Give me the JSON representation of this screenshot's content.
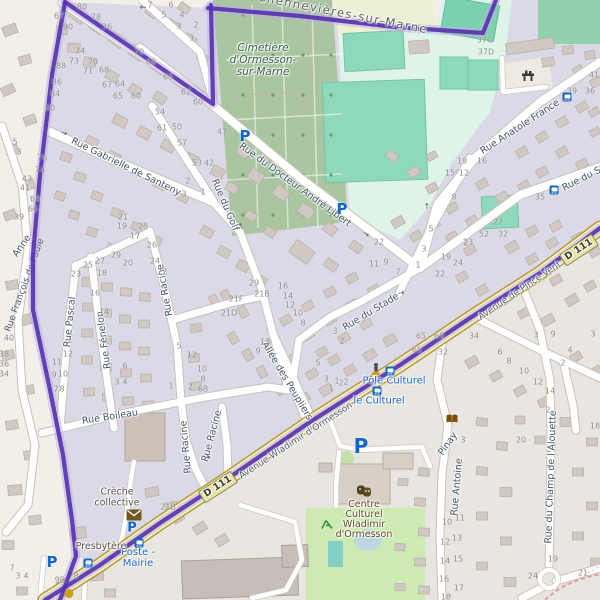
{
  "admin_label": "Chennevières-sur-Marne",
  "cemetery_label": {
    "lines": [
      "Cimetière",
      "d'Ormesson-",
      "sur-Marne"
    ]
  },
  "road_refs": [
    {
      "label": "D 111",
      "x": 218,
      "y": 487,
      "rot": -33
    },
    {
      "label": "D 111",
      "x": 579,
      "y": 250,
      "rot": -33
    }
  ],
  "streets": [
    {
      "label": "Rue Gabrielle de Santeny",
      "x": 126,
      "y": 167,
      "rot": 26
    },
    {
      "label": "Rue du Docteur André Libert",
      "x": 295,
      "y": 185,
      "rot": 36
    },
    {
      "label": "Rue du Golf",
      "x": 225,
      "y": 205,
      "rot": 67
    },
    {
      "label": "Rue Pascal",
      "x": 70,
      "y": 322,
      "rot": -84
    },
    {
      "label": "Rue Fénelon",
      "x": 104,
      "y": 340,
      "rot": -98
    },
    {
      "label": "Rue Racine",
      "x": 165,
      "y": 290,
      "rot": -100
    },
    {
      "label": "Rue Racine",
      "x": 186,
      "y": 447,
      "rot": -95
    },
    {
      "label": "Rue Racine",
      "x": 212,
      "y": 436,
      "rot": -75
    },
    {
      "label": "Rue Boileau",
      "x": 110,
      "y": 417,
      "rot": -9
    },
    {
      "label": "Allée des Peupliers",
      "x": 287,
      "y": 381,
      "rot": 59
    },
    {
      "label": "Rue du Stade",
      "x": 371,
      "y": 312,
      "rot": -31
    },
    {
      "label": "Rue du Sta",
      "x": 586,
      "y": 177,
      "rot": -27
    },
    {
      "label": "Rue Anatole France",
      "x": 520,
      "y": 127,
      "rot": -33
    },
    {
      "label": "Avenue Wladimir d'Ormesson",
      "x": 296,
      "y": 441,
      "rot": -33,
      "onroad": true
    },
    {
      "label": "Avenue de Pince Vent",
      "x": 520,
      "y": 291,
      "rot": -34,
      "onroad": true
    },
    {
      "label": "Rue Antoine",
      "x": 457,
      "y": 487,
      "rot": -85
    },
    {
      "label": "Pinay",
      "x": 448,
      "y": 444,
      "rot": -55
    },
    {
      "label": "Rue du Champ de l'Alouette",
      "x": 551,
      "y": 477,
      "rot": -88
    },
    {
      "label": "Anne",
      "x": 22,
      "y": 246,
      "rot": -55
    }
  ],
  "street_under_boundary": {
    "label": "Rue François de Paule",
    "x": 24,
    "y": 285,
    "rot": -70
  },
  "bus_stops": [
    {
      "lines": [
        "Poste -",
        "Mairie"
      ],
      "x": 138,
      "y": 558
    },
    {
      "lines": [
        "Pôle Culturel"
      ],
      "x": 394,
      "y": 381
    },
    {
      "lines": [
        "le Culturel"
      ],
      "x": 379,
      "y": 401
    }
  ],
  "pois": [
    {
      "lines": [
        "Crèche",
        "collective"
      ],
      "x": 117,
      "y": 498,
      "cls": "poi"
    },
    {
      "lines": [
        "Presbytère"
      ],
      "x": 101,
      "y": 547,
      "cls": "poi"
    },
    {
      "lines": [
        "Centre",
        "Culturel",
        "Wladimir",
        "d'Ormesson"
      ],
      "x": 364,
      "y": 520,
      "cls": "poi-brown"
    }
  ],
  "parking_icons": [
    {
      "x": 245,
      "y": 136,
      "s": 15
    },
    {
      "x": 342,
      "y": 209,
      "s": 15
    },
    {
      "x": 132,
      "y": 528,
      "s": 13
    },
    {
      "x": 52,
      "y": 562,
      "s": 15
    },
    {
      "x": 361,
      "y": 446,
      "s": 20
    }
  ],
  "bus_icons": [
    {
      "x": 567,
      "y": 97
    },
    {
      "x": 554,
      "y": 190
    },
    {
      "x": 390,
      "y": 371
    },
    {
      "x": 377,
      "y": 391
    },
    {
      "x": 139,
      "y": 543
    },
    {
      "x": 88,
      "y": 563
    }
  ],
  "poi_icons": [
    {
      "name": "post-box-icon",
      "x": 134,
      "y": 515
    },
    {
      "name": "theatre-masks-icon",
      "x": 364,
      "y": 491
    },
    {
      "name": "library-book-icon",
      "x": 452,
      "y": 419
    },
    {
      "name": "statue-icon",
      "x": 376,
      "y": 370
    },
    {
      "name": "fitness-station-icon",
      "x": 528,
      "y": 76
    },
    {
      "name": "playground-icon",
      "x": 327,
      "y": 524
    },
    {
      "name": "place-of-worship-icon",
      "x": 69,
      "y": 593
    }
  ],
  "oneway_arrows": [
    {
      "x": 64,
      "y": 133,
      "rot": 20
    },
    {
      "x": 366,
      "y": 234,
      "rot": 36
    },
    {
      "x": 401,
      "y": 293,
      "rot": -12
    },
    {
      "x": 241,
      "y": 226,
      "rot": 245
    },
    {
      "x": 208,
      "y": 456,
      "rot": 60
    },
    {
      "x": 427,
      "y": 206,
      "rot": -90
    },
    {
      "x": 143,
      "y": 7,
      "rot": 180
    }
  ],
  "house_numbers": [
    {
      "t": "80",
      "x": 82,
      "y": 7
    },
    {
      "t": "78",
      "x": 96,
      "y": 17
    },
    {
      "t": "76",
      "x": 107,
      "y": 27
    },
    {
      "t": "74",
      "x": 80,
      "y": 51
    },
    {
      "t": "73",
      "x": 74,
      "y": 61
    },
    {
      "t": "70",
      "x": 93,
      "y": 62
    },
    {
      "t": "71",
      "x": 88,
      "y": 71
    },
    {
      "t": "68",
      "x": 104,
      "y": 70
    },
    {
      "t": "67",
      "x": 59,
      "y": 16
    },
    {
      "t": "90",
      "x": 68,
      "y": 27
    },
    {
      "t": "88",
      "x": 61,
      "y": 66
    },
    {
      "t": "86",
      "x": 57,
      "y": 82
    },
    {
      "t": "84",
      "x": 55,
      "y": 94
    },
    {
      "t": "80",
      "x": 50,
      "y": 108
    },
    {
      "t": "7",
      "x": 150,
      "y": 5
    },
    {
      "t": "6",
      "x": 171,
      "y": 5
    },
    {
      "t": "5",
      "x": 164,
      "y": 15
    },
    {
      "t": "4",
      "x": 182,
      "y": 15
    },
    {
      "t": "3",
      "x": 179,
      "y": 26
    },
    {
      "t": "2",
      "x": 196,
      "y": 25
    },
    {
      "t": "1",
      "x": 192,
      "y": 38
    },
    {
      "t": "67",
      "x": 107,
      "y": 85
    },
    {
      "t": "64",
      "x": 120,
      "y": 84
    },
    {
      "t": "65",
      "x": 118,
      "y": 96
    },
    {
      "t": "60",
      "x": 136,
      "y": 96
    },
    {
      "t": "54",
      "x": 160,
      "y": 112
    },
    {
      "t": "66",
      "x": 168,
      "y": 77
    },
    {
      "t": "68",
      "x": 151,
      "y": 62
    },
    {
      "t": "70",
      "x": 139,
      "y": 52
    },
    {
      "t": "62",
      "x": 186,
      "y": 92
    },
    {
      "t": "60",
      "x": 198,
      "y": 102
    },
    {
      "t": "61",
      "x": 162,
      "y": 128
    },
    {
      "t": "50",
      "x": 177,
      "y": 127
    },
    {
      "t": "57",
      "x": 182,
      "y": 143
    },
    {
      "t": "53",
      "x": 197,
      "y": 163
    },
    {
      "t": "42",
      "x": 209,
      "y": 163
    },
    {
      "t": "2",
      "x": 188,
      "y": 181
    },
    {
      "t": "3",
      "x": 184,
      "y": 194
    },
    {
      "t": "1",
      "x": 203,
      "y": 192
    },
    {
      "t": "21",
      "x": 123,
      "y": 217
    },
    {
      "t": "19",
      "x": 122,
      "y": 226
    },
    {
      "t": "28",
      "x": 143,
      "y": 226
    },
    {
      "t": "17",
      "x": 135,
      "y": 236
    },
    {
      "t": "26",
      "x": 152,
      "y": 245
    },
    {
      "t": "43",
      "x": 27,
      "y": 179
    },
    {
      "t": "41",
      "x": 25,
      "y": 188
    },
    {
      "t": "68",
      "x": 35,
      "y": 199
    },
    {
      "t": "66",
      "x": 33,
      "y": 209
    },
    {
      "t": "39",
      "x": 19,
      "y": 217
    },
    {
      "t": "5",
      "x": 15,
      "y": 142
    },
    {
      "t": "3",
      "x": 19,
      "y": 152
    },
    {
      "t": "76",
      "x": 42,
      "y": 158
    },
    {
      "t": "74",
      "x": 40,
      "y": 170
    },
    {
      "t": "47",
      "x": 222,
      "y": 132
    },
    {
      "t": "27",
      "x": 100,
      "y": 261
    },
    {
      "t": "29",
      "x": 116,
      "y": 255
    },
    {
      "t": "25",
      "x": 88,
      "y": 265
    },
    {
      "t": "20",
      "x": 128,
      "y": 263
    },
    {
      "t": "23",
      "x": 76,
      "y": 274
    },
    {
      "t": "24",
      "x": 155,
      "y": 261
    },
    {
      "t": "22",
      "x": 162,
      "y": 272
    },
    {
      "t": "18",
      "x": 102,
      "y": 273
    },
    {
      "t": "16",
      "x": 95,
      "y": 293
    },
    {
      "t": "14",
      "x": 104,
      "y": 312
    },
    {
      "t": "40",
      "x": 9,
      "y": 338
    },
    {
      "t": "38",
      "x": 4,
      "y": 354
    },
    {
      "t": "36",
      "x": 4,
      "y": 364
    },
    {
      "t": "34",
      "x": 4,
      "y": 374
    },
    {
      "t": "12",
      "x": 68,
      "y": 354
    },
    {
      "t": "11",
      "x": 57,
      "y": 362
    },
    {
      "t": "10",
      "x": 63,
      "y": 374
    },
    {
      "t": "9",
      "x": 54,
      "y": 375
    },
    {
      "t": "7",
      "x": 56,
      "y": 389
    },
    {
      "t": "8",
      "x": 62,
      "y": 389
    },
    {
      "t": "6",
      "x": 125,
      "y": 366
    },
    {
      "t": "3",
      "x": 117,
      "y": 382
    },
    {
      "t": "4",
      "x": 125,
      "y": 382
    },
    {
      "t": "5",
      "x": 179,
      "y": 346
    },
    {
      "t": "12",
      "x": 192,
      "y": 355
    },
    {
      "t": "1",
      "x": 171,
      "y": 386
    },
    {
      "t": "2",
      "x": 190,
      "y": 387
    },
    {
      "t": "21F",
      "x": 236,
      "y": 299
    },
    {
      "t": "21B",
      "x": 262,
      "y": 294
    },
    {
      "t": "21D",
      "x": 229,
      "y": 313
    },
    {
      "t": "29",
      "x": 254,
      "y": 283
    },
    {
      "t": "16",
      "x": 283,
      "y": 286
    },
    {
      "t": "14",
      "x": 288,
      "y": 296
    },
    {
      "t": "12",
      "x": 290,
      "y": 305
    },
    {
      "t": "10",
      "x": 298,
      "y": 313
    },
    {
      "t": "8",
      "x": 303,
      "y": 323
    },
    {
      "t": "13",
      "x": 265,
      "y": 342
    },
    {
      "t": "9",
      "x": 258,
      "y": 351
    },
    {
      "t": "10",
      "x": 202,
      "y": 369
    },
    {
      "t": "8",
      "x": 203,
      "y": 379
    },
    {
      "t": "6B",
      "x": 203,
      "y": 389
    },
    {
      "t": "3",
      "x": 326,
      "y": 379
    },
    {
      "t": "1",
      "x": 331,
      "y": 388
    },
    {
      "t": "2",
      "x": 341,
      "y": 383
    },
    {
      "t": "5",
      "x": 318,
      "y": 363
    },
    {
      "t": "3",
      "x": 335,
      "y": 331
    },
    {
      "t": "2",
      "x": 342,
      "y": 341
    },
    {
      "t": "22",
      "x": 379,
      "y": 242
    },
    {
      "t": "5",
      "x": 431,
      "y": 229
    },
    {
      "t": "3",
      "x": 424,
      "y": 249
    },
    {
      "t": "1",
      "x": 418,
      "y": 265
    },
    {
      "t": "22",
      "x": 440,
      "y": 274
    },
    {
      "t": "19",
      "x": 446,
      "y": 257
    },
    {
      "t": "24",
      "x": 458,
      "y": 263
    },
    {
      "t": "2",
      "x": 466,
      "y": 243
    },
    {
      "t": "11",
      "x": 374,
      "y": 264
    },
    {
      "t": "9",
      "x": 386,
      "y": 262
    },
    {
      "t": "7",
      "x": 398,
      "y": 272
    },
    {
      "t": "35",
      "x": 540,
      "y": 197
    },
    {
      "t": "27",
      "x": 498,
      "y": 222
    },
    {
      "t": "52",
      "x": 484,
      "y": 234
    },
    {
      "t": "32",
      "x": 503,
      "y": 234
    },
    {
      "t": "23",
      "x": 468,
      "y": 242
    },
    {
      "t": "15",
      "x": 450,
      "y": 173
    },
    {
      "t": "12",
      "x": 464,
      "y": 173
    },
    {
      "t": "19",
      "x": 462,
      "y": 161
    },
    {
      "t": "16",
      "x": 482,
      "y": 161
    },
    {
      "t": "8",
      "x": 454,
      "y": 197
    },
    {
      "t": "41",
      "x": 594,
      "y": 75
    },
    {
      "t": "39",
      "x": 572,
      "y": 91
    },
    {
      "t": "36",
      "x": 590,
      "y": 91
    },
    {
      "t": "37G",
      "x": 485,
      "y": 40
    },
    {
      "t": "37D",
      "x": 486,
      "y": 52
    },
    {
      "t": "65 - 69",
      "x": 430,
      "y": 336
    },
    {
      "t": "65",
      "x": 417,
      "y": 350
    },
    {
      "t": "32",
      "x": 443,
      "y": 352
    },
    {
      "t": "34",
      "x": 474,
      "y": 336
    },
    {
      "t": "6",
      "x": 500,
      "y": 352
    },
    {
      "t": "8",
      "x": 509,
      "y": 361
    },
    {
      "t": "10",
      "x": 524,
      "y": 371
    },
    {
      "t": "12",
      "x": 538,
      "y": 382
    },
    {
      "t": "14",
      "x": 550,
      "y": 391
    },
    {
      "t": "3",
      "x": 536,
      "y": 335
    },
    {
      "t": "9",
      "x": 553,
      "y": 334
    },
    {
      "t": "4",
      "x": 570,
      "y": 350
    },
    {
      "t": "2",
      "x": 563,
      "y": 363
    },
    {
      "t": "2",
      "x": 548,
      "y": 410
    },
    {
      "t": "18",
      "x": 595,
      "y": 426
    },
    {
      "t": "3",
      "x": 463,
      "y": 440
    },
    {
      "t": "20",
      "x": 521,
      "y": 440
    },
    {
      "t": "10",
      "x": 447,
      "y": 522
    },
    {
      "t": "11",
      "x": 460,
      "y": 518
    },
    {
      "t": "12",
      "x": 445,
      "y": 542
    },
    {
      "t": "13",
      "x": 457,
      "y": 538
    },
    {
      "t": "14",
      "x": 445,
      "y": 561
    },
    {
      "t": "15",
      "x": 458,
      "y": 559
    },
    {
      "t": "16",
      "x": 444,
      "y": 579
    },
    {
      "t": "17",
      "x": 459,
      "y": 588
    },
    {
      "t": "18",
      "x": 446,
      "y": 597
    },
    {
      "t": "19",
      "x": 553,
      "y": 559
    },
    {
      "t": "24",
      "x": 533,
      "y": 576
    },
    {
      "t": "21",
      "x": 583,
      "y": 573
    },
    {
      "t": "3",
      "x": 593,
      "y": 334
    },
    {
      "t": "7",
      "x": 12,
      "y": 568
    },
    {
      "t": "3",
      "x": 18,
      "y": 576
    },
    {
      "t": "4",
      "x": 26,
      "y": 576
    },
    {
      "t": "9B",
      "x": 60,
      "y": 580
    },
    {
      "t": "8",
      "x": 76,
      "y": 576
    },
    {
      "t": "21B",
      "x": 168,
      "y": 507
    },
    {
      "t": "1",
      "x": 337,
      "y": 381
    },
    {
      "t": "2",
      "x": 346,
      "y": 382
    }
  ],
  "colors": {
    "residential": "#dcd9e6",
    "outside": "#f2efe9",
    "south": "#e9e5e0",
    "cemetery": "#a9c6a0",
    "sports_centre": "#def4e8",
    "pitch": "#8ed8bc",
    "park": "#cdeab2",
    "road_yellow": "#f8f3c2",
    "boundary_purple": "#5531ae",
    "bus_blue": "#1a66cc",
    "parking_blue": "#1166cc"
  }
}
